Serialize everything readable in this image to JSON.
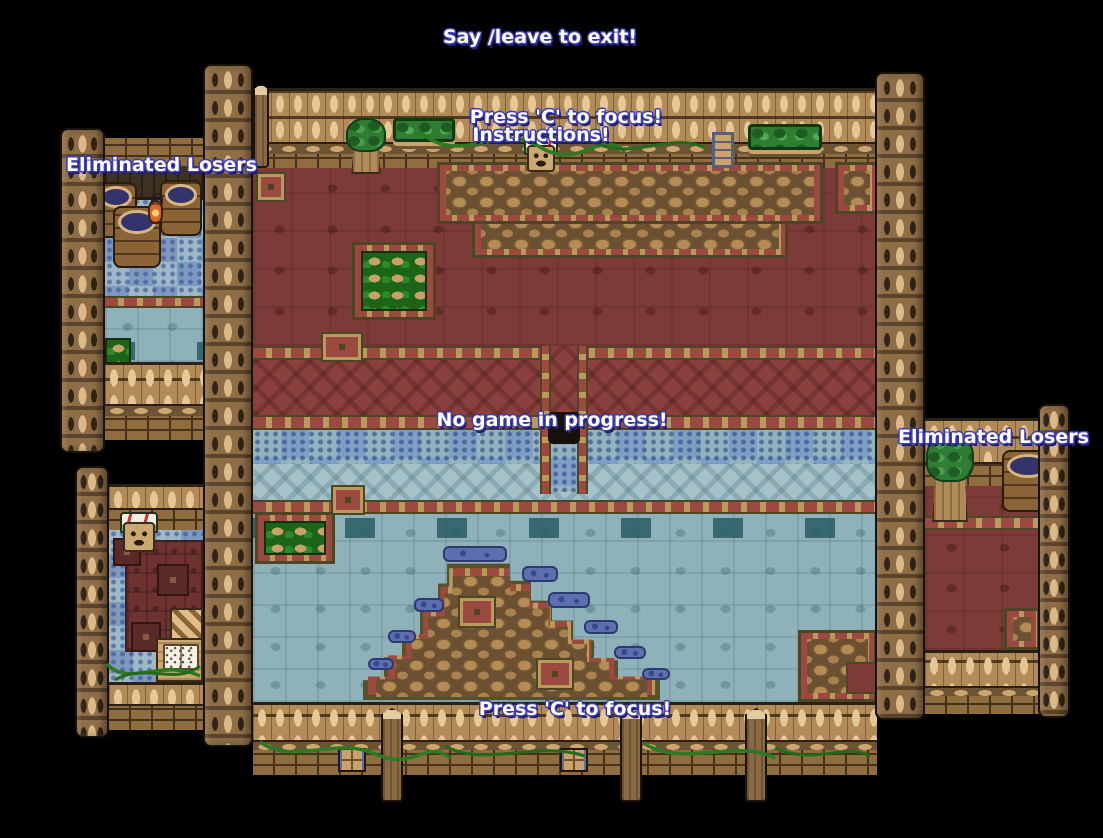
{
  "scene": {
    "name": "pixel-arena-lobby",
    "background": "#000000"
  },
  "messages": {
    "exit_hint": "Say /leave to exit!",
    "focus_hint_top": "Press 'C' to focus!",
    "instructions_label": "Instructions!",
    "status": "No game in progress!",
    "eliminated_left": "Eliminated Losers",
    "eliminated_right": "Eliminated Losers",
    "focus_hint_bottom": "Press 'C' to focus!"
  },
  "colors": {
    "text_fill": "#ffffff",
    "text_outline": "#3a3ab4",
    "wall_wood": "#b28b5a",
    "pillar_wood": "#8a6a44",
    "brick": "#8f6d41",
    "floor_red_upper": "#7c3b37",
    "carpet_red": "#8a403c",
    "tile_border_tan": "#b99a5c",
    "tile_border_red": "#9c4a40",
    "water_checker_light": "#93b4bc",
    "water_checker_blue": "#7d9fc4",
    "floor_blue_gray": "#8fb2ba",
    "moss_green": "#1c6418",
    "dirt_stone": "#b68c55",
    "barrel_water": "#33346b"
  },
  "objects": {
    "npc_instructions": "mushroom-npc",
    "npc_left_room": "mushroom-npc",
    "barrels_left_room": 3,
    "barrel_right_room": 1,
    "planter_trees": 2,
    "hedge_boxes": 2,
    "ladder": 1,
    "book_desk": 1,
    "lantern": 1,
    "fence_posts_bottom": 3
  }
}
